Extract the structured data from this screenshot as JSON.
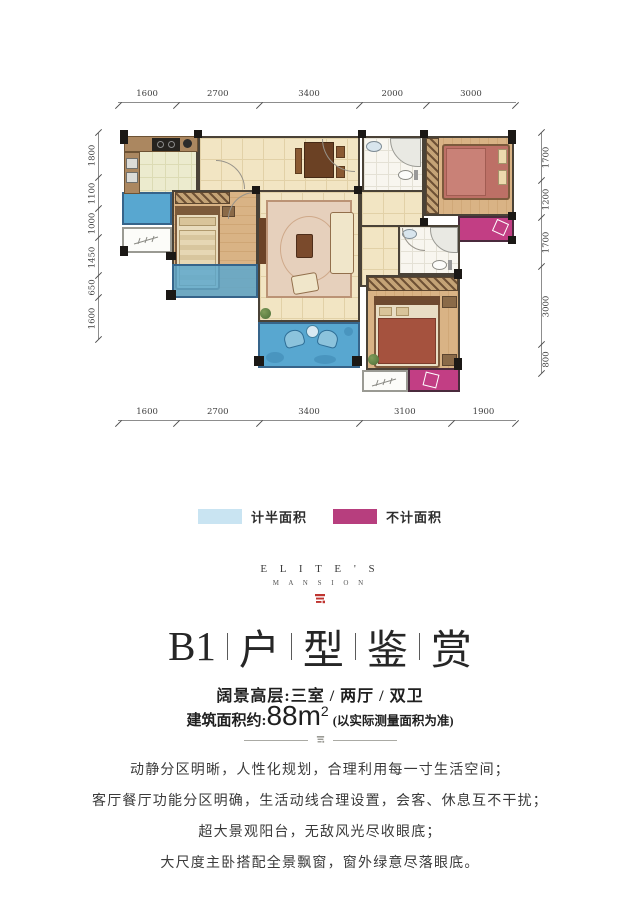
{
  "floor_plan": {
    "dims_top": [
      "1600",
      "2700",
      "3400",
      "2000",
      "3000"
    ],
    "dims_bottom": [
      "1600",
      "2700",
      "3400",
      "3100",
      "1900"
    ],
    "dims_left": [
      "1800",
      "1100",
      "1000",
      "1450",
      "650",
      "1600"
    ],
    "dims_right": [
      "1700",
      "1200",
      "1700",
      "3000",
      "800"
    ],
    "colors": {
      "half_area_fill": "#58a7d0",
      "excluded_area_fill": "#c23e84",
      "tile_floor": "#f2e5c3",
      "wood_floor": "#d9b385",
      "wall": "#1b1815"
    }
  },
  "legend": {
    "items": [
      {
        "label": "计半面积",
        "color": "#c9e4f2"
      },
      {
        "label": "不计面积",
        "color": "#b73e7e"
      }
    ]
  },
  "brand": {
    "name": "E L I T E ' S",
    "subname": "M A N S I O N",
    "logo_color": "#bf3430"
  },
  "title": {
    "segments": [
      "B1",
      "户",
      "型",
      "鉴",
      "赏"
    ]
  },
  "subtitle": "阔景高层:三室 / 两厅 / 双卫",
  "area": {
    "label": "建筑面积约:",
    "value": "88m",
    "sup": "2",
    "note": "(以实际测量面积为准)"
  },
  "description": [
    "动静分区明晰，人性化规划，合理利用每一寸生活空间；",
    "客厅餐厅功能分区明确，生活动线合理设置，会客、休息互不干扰；",
    "超大景观阳台，无敌风光尽收眼底；",
    "大尺度主卧搭配全景飘窗，窗外绿意尽落眼底。"
  ]
}
